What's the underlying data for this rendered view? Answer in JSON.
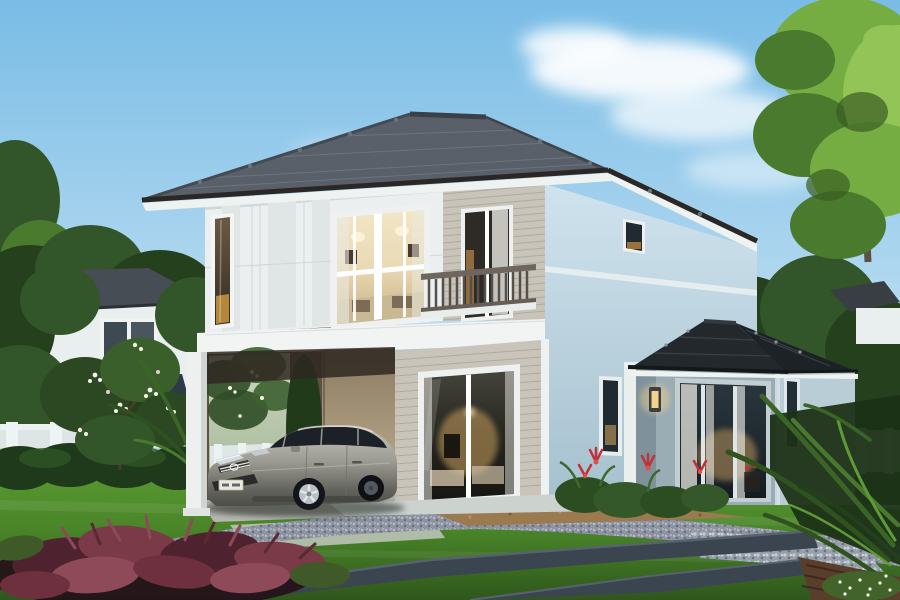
{
  "scene": {
    "description": "Architectural rendering of a modern two-storey suburban house at dusk: grey hip tile roof, white panel and beige siding facade, lit picture windows, balcony with dark railing, open carport with a silver hatchback parked inside, single-storey glass pavilion extension with dark roof, manicured lawn with slate paths and gravel, tropical plants, neighbouring houses among trees under a blue sky with soft clouds."
  },
  "objects": {
    "sky": {
      "label": "blue sky"
    },
    "clouds": {
      "label": "soft white clouds"
    },
    "trees_left": {
      "label": "trees behind left neighbouring house"
    },
    "trees_right": {
      "label": "dense trees behind extension"
    },
    "tree_top_right": {
      "label": "tall bright green tree in top right corner"
    },
    "house_left": {
      "label": "white neighbouring house with grey roof"
    },
    "house_right": {
      "label": "neighbouring roof behind trees on the right"
    },
    "fence_left": {
      "label": "white garden fence on the left"
    },
    "fence_right": {
      "label": "white garden fence on the right"
    },
    "hedge": {
      "label": "dark green hedge row"
    },
    "plumeria": {
      "label": "plumeria shrubs with white blossoms"
    },
    "palm_left": {
      "label": "palm fronds beside the carport"
    },
    "main_house": {
      "label": "two-storey house"
    },
    "roof": {
      "label": "grey hip tile roof with dark fascia and white soffit"
    },
    "second_floor": {
      "label": "second floor facade"
    },
    "panel_facade": {
      "label": "white vertical panel cladding"
    },
    "narrow_window": {
      "label": "tall narrow window with warm light"
    },
    "picture_window": {
      "label": "large lit picture window"
    },
    "balcony_door": {
      "label": "balcony glass door"
    },
    "siding_upper": {
      "label": "beige horizontal siding, upper floor"
    },
    "balcony_railing": {
      "label": "dark wood balcony railing"
    },
    "floor_band": {
      "label": "white intermediate floor band"
    },
    "side_wall": {
      "label": "light blue right side wall"
    },
    "side_window_upper": {
      "label": "small upper side window"
    },
    "side_pillar": {
      "label": "white trim pillar"
    },
    "side_window_lower": {
      "label": "narrow ground floor window"
    },
    "first_floor": {
      "label": "ground floor with beige siding"
    },
    "sliding_door": {
      "label": "lit sliding glass door"
    },
    "carport": {
      "label": "open carport under the second floor"
    },
    "carport_interior": {
      "label": "view through carport to back garden"
    },
    "carport_post": {
      "label": "white carport post"
    },
    "car": {
      "label": "silver hatchback parked in the carport"
    },
    "license_plate": {
      "label": "white license plate"
    },
    "extension": {
      "label": "single-storey glass pavilion extension"
    },
    "extension_roof": {
      "label": "dark charcoal hip roof of extension"
    },
    "extension_glass_wall": {
      "label": "glass wall with white curtains"
    },
    "extension_side_window": {
      "label": "narrow side window of extension"
    },
    "wall_lamp": {
      "label": "lit warm wall lamp"
    },
    "ground": {
      "label": "front garden ground"
    },
    "lawn": {
      "label": "green lawn"
    },
    "driveway": {
      "label": "gravel driveway"
    },
    "concrete_pad": {
      "label": "light concrete apron"
    },
    "tan_bed": {
      "label": "tan gravel planting bed"
    },
    "stepping_stones": {
      "label": "slate paths across the lawn"
    },
    "pebble_bed": {
      "label": "grey pebble bed"
    },
    "wood_deck": {
      "label": "wooden deck corner"
    },
    "red_shrub": {
      "label": "wine-red foliage shrub"
    },
    "red_flowers": {
      "label": "red bromeliad flowers by the extension"
    },
    "palm_right": {
      "label": "tropical palm leaves in lower right corner"
    },
    "white_flowers": {
      "label": "white speckled ground flowers"
    }
  },
  "palette": {
    "sky_top": "#79bce6",
    "sky_mid": "#b9dcf1",
    "sky_low": "#e4f1f4",
    "cloud": "#ffffff",
    "tree_dark": "#24401d",
    "tree_mid": "#33552a",
    "tree_light": "#4a7a2e",
    "tree_bright": "#76ad43",
    "tree_glow": "#93c457",
    "bg_wall": "#e9efef",
    "bg_roof": "#474d54",
    "bg_roof_dark": "#2e3a48",
    "fence_white": "#dde6e5",
    "hedge_green": "#1f3a1a",
    "roof_main": "#59606a",
    "roof_side": "#4a5058",
    "roof_fascia": "#2b2724",
    "soffit_white": "#eef2f1",
    "wall_white": "#eceff0",
    "panel_tint": "#e0e6e5",
    "siding": "#c8c4ba",
    "siding_line": "#aeaaa0",
    "band_white": "#f1f4f3",
    "sidewall_top": "#cfe3ed",
    "sidewall_low": "#a6c0ce",
    "ext_roof": "#23282c",
    "ext_front": "#9aacb4",
    "ext_side": "#b9cdd7",
    "ext_return": "#7f929b",
    "frame_white": "#eef1ef",
    "glass_dark": "#1f2a31",
    "glass_warm": "#caa05f",
    "interior_cream": "#ead9b4",
    "lamp_glow": "#f6d289",
    "curtain_white": "#e9e9e2",
    "rail_dark": "#6e665e",
    "baluster": "#57504a",
    "carport_shadow": "#2f2821",
    "carport_wall_lit": "#c4b392",
    "carport_wall_shade": "#8a7a62",
    "car_silver": "#9a9a92",
    "car_silver_light": "#c6c6be",
    "car_silver_dark": "#63635d",
    "car_glass": "#1b2127",
    "wheel_dark": "#13151a",
    "rim_silver": "#b9c0c6",
    "lawn_light": "#5c9c33",
    "lawn_dark": "#2f571c",
    "gravel_base": "#8d93a0",
    "tan_bed_c": "#9c7a50",
    "slate": "#3a4550",
    "slate_edge": "#56626e",
    "pebble": "#97a0aa",
    "deck_wood": "#5a3e2c",
    "shrub_wine": "#7a3a48",
    "shrub_wine_dark": "#4f2230",
    "flower_red": "#c23038",
    "flower_white": "#f4f1e8",
    "concrete_pad_c": "#c2c7c0"
  }
}
